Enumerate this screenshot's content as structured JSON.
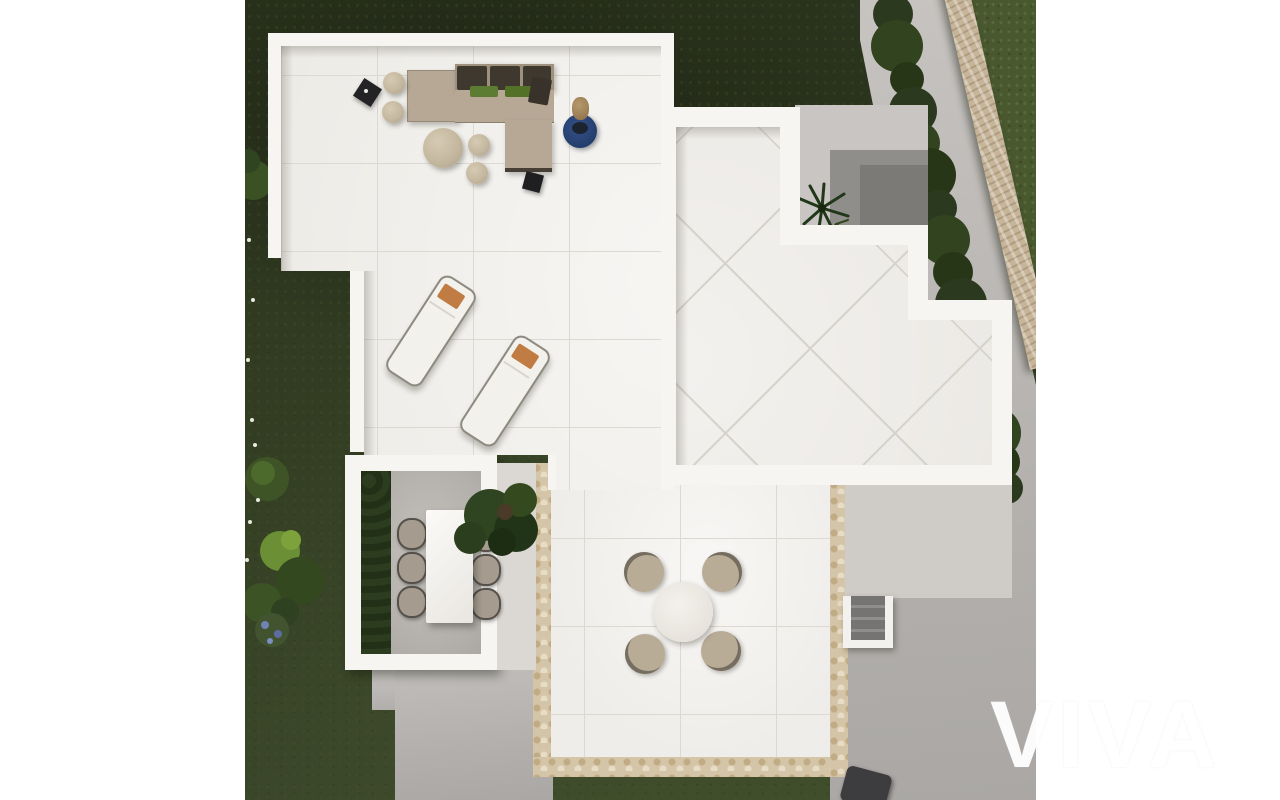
{
  "meta": {
    "description": "Aerial top-down 3D architectural render of a modern villa rooftop solarium and garden",
    "watermark": {
      "text": "VIVA"
    }
  },
  "palette": {
    "margin_white": "#ffffff",
    "grass_dark": "#333e23",
    "grass_bright": "#49582f",
    "terrace_tile": "#edebe6",
    "roof_tile": "#e9e6e1",
    "parapet_white": "#f6f5f2",
    "concrete_path": "#b8b5b2",
    "stone_wall": "#c7b59a",
    "stone_trim": "#d5c5a8",
    "sofa_taupe": "#b7a896",
    "cushion_dark": "#3f382f",
    "pillow_green": "#5d7c33",
    "lounger_pillow_orange": "#c07c43",
    "rug_blue": "#2d4875",
    "hedge_green": "#2b3a1e"
  },
  "scene": {
    "objects": [
      "rooftop-solarium-terrace",
      "corner-sofa-with-green-pillows",
      "round-coffee-table",
      "poufs",
      "decorative-bust-on-blue-rug",
      "black-side-table",
      "sun-lounger",
      "sun-lounger",
      "stepped-tiled-roof",
      "inner-courtyard-palm",
      "boundary-stone-wall",
      "perimeter-hedge",
      "lawn",
      "garden-shrubs",
      "outdoor-dining-table-six-chairs",
      "potted-plant",
      "round-bistro-table-four-chairs",
      "staircase",
      "barbecue-grill",
      "stone-trimmed-terrace"
    ]
  }
}
